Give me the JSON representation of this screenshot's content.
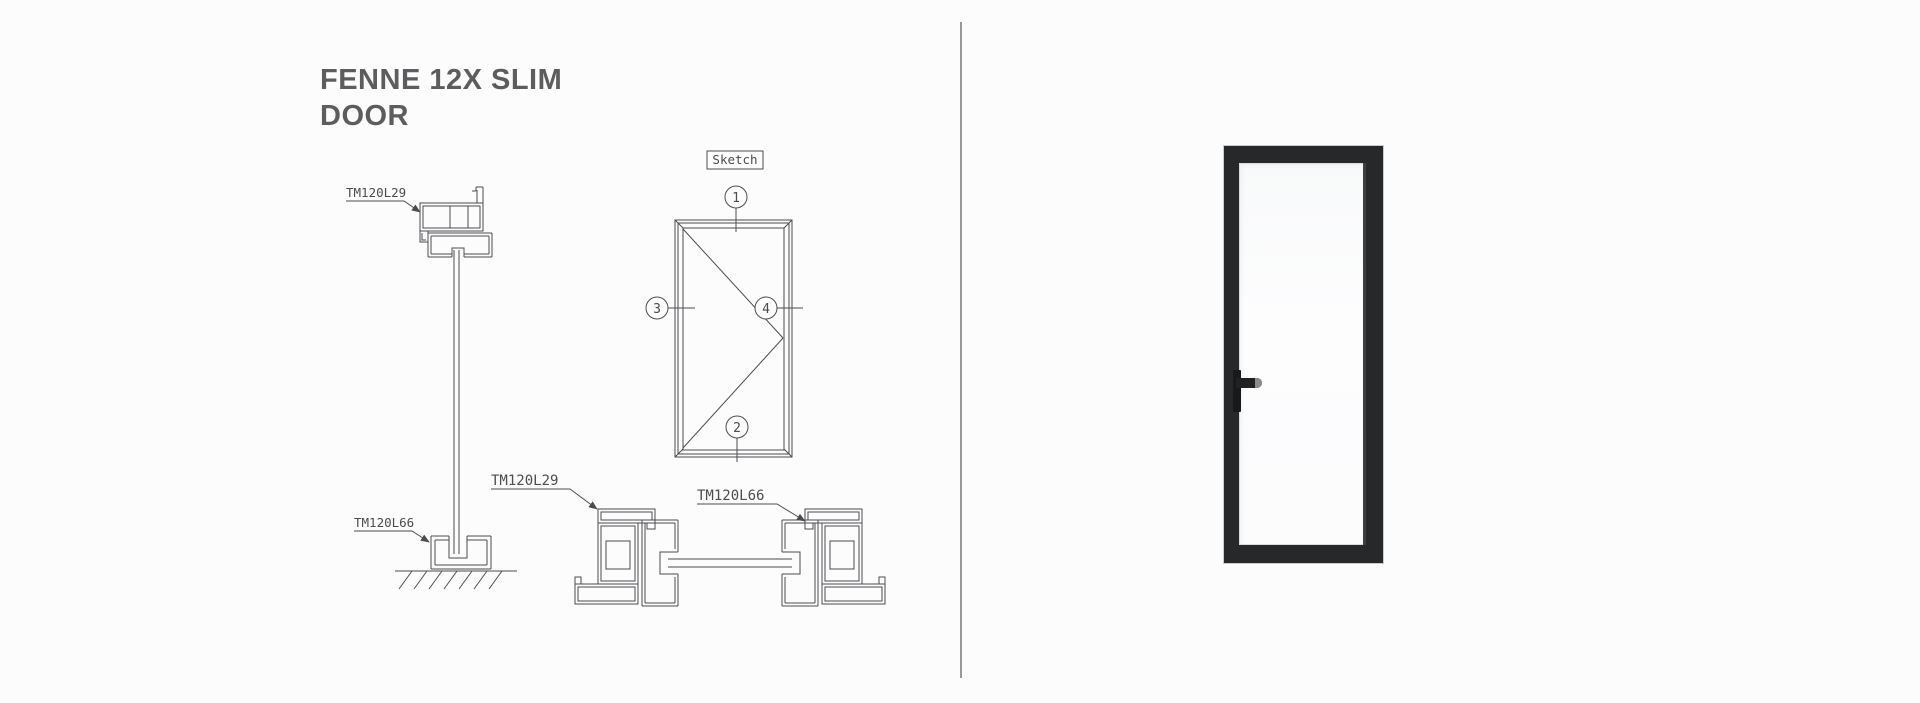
{
  "page": {
    "title_line1": "FENNE 12X SLIM",
    "title_line2": "DOOR"
  },
  "drawings": {
    "sketch_label": "Sketch",
    "callout_1": "1",
    "callout_2": "2",
    "callout_3": "3",
    "callout_4": "4",
    "vertical_section": {
      "head_profile_label": "TM120L29",
      "floor_profile_label": "TM120L66"
    },
    "horizontal_section": {
      "frame_profile_label": "TM120L29",
      "leaf_profile_label": "TM120L66"
    }
  },
  "colors": {
    "background": "#fcfcfc",
    "title_text": "#5c5d5f",
    "drawing_lines": "#4c4d4f",
    "separator": "#96989a",
    "door_frame": "#26282a",
    "door_glass": "#fdfdfe",
    "handle": "#17191b"
  }
}
